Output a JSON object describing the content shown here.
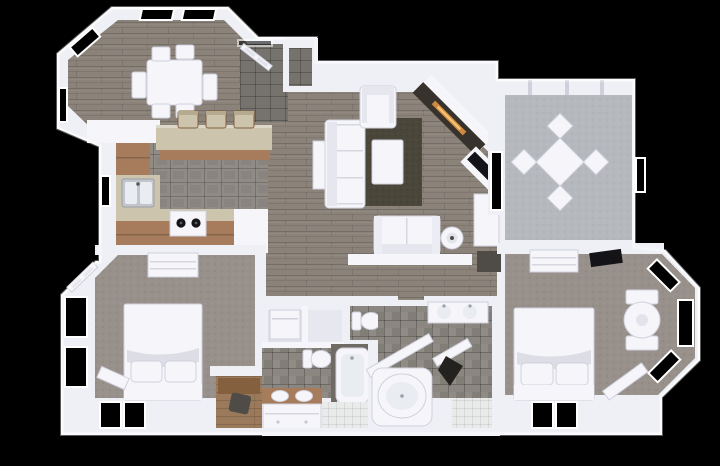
{
  "scene": {
    "title": "3D top-down render of a two-bedroom apartment floor plan on a black background",
    "view": "top-down 3D dollhouse render",
    "background": "#000000"
  },
  "palette": {
    "wall": "#eef0f5",
    "wallEdge": "#fbfbfd",
    "furniture": "#f6f6fa",
    "furnitureShade": "#cfd0dc",
    "wood": "#8b8279",
    "woodLine": "#6f675f",
    "entryTile": "#76726d",
    "kitchenTile": "#908b85",
    "counter": "#cdc4ae",
    "cabinet": "#a67c5c",
    "cabinetDark": "#84603f",
    "deskWood": "#9b7a5c",
    "carpet": "#98908a",
    "sunCarpet": "#b5b8bc",
    "rug": "#4a4639",
    "stone": "#38322c",
    "fire": "#d08a3e",
    "tv": "#141418",
    "steel": "#c2c6cc",
    "basin": "#e9ecf1",
    "bathTile": "#8b8680",
    "tileDark": "#6f6a64",
    "whiteTile": "#e9eaea",
    "windowVoid": "#000000",
    "matDark": "#4f4c47"
  },
  "rooms": [
    {
      "id": "dining-nook",
      "floor": "wood",
      "furniture": [
        "dining-table",
        "six-chairs"
      ]
    },
    {
      "id": "kitchen",
      "floor": "gray-tile",
      "furniture": [
        "breakfast-bar",
        "bar-stools-x3",
        "double-sink",
        "range-two-burners",
        "wood-cabinets",
        "refrigerator-cabinet"
      ]
    },
    {
      "id": "entry",
      "floor": "slate-tile",
      "furniture": [
        "front-door-open"
      ]
    },
    {
      "id": "coat-closet",
      "floor": "slate-tile",
      "furniture": []
    },
    {
      "id": "living-room",
      "floor": "wood",
      "furniture": [
        "sofa",
        "armchair",
        "loveseat",
        "coffee-table",
        "area-rug",
        "round-side-table",
        "corner-fireplace",
        "tv-on-angled-stand",
        "console-cabinet",
        "door-mat"
      ]
    },
    {
      "id": "sunroom",
      "floor": "light-gray-carpet",
      "furniture": [
        "square-table-diagonal",
        "four-chairs"
      ]
    },
    {
      "id": "bedroom-left",
      "floor": "carpet",
      "furniture": [
        "bed-with-pillows",
        "dresser",
        "corner-bench",
        "desk-nook-with-chair",
        "open-door"
      ]
    },
    {
      "id": "bedroom-right",
      "floor": "carpet",
      "furniture": [
        "bed-with-pillows",
        "dresser",
        "bay-window-round-table",
        "two-chairs",
        "angled-bench",
        "leaning-mirror"
      ]
    },
    {
      "id": "bathroom-left",
      "floor": "gray-tile",
      "furniture": [
        "double-vanity-wood-top",
        "bathtub",
        "toilet"
      ]
    },
    {
      "id": "bathroom-right",
      "floor": "gray-tile",
      "furniture": [
        "double-vanity-white",
        "garden-tub",
        "angled-shower-walls",
        "hanging-robe"
      ]
    },
    {
      "id": "water-closet",
      "floor": "gray-tile",
      "furniture": [
        "toilet"
      ]
    },
    {
      "id": "laundry-closet",
      "floor": "white",
      "furniture": [
        "washer",
        "shelf"
      ]
    },
    {
      "id": "hallway",
      "floor": "wood",
      "furniture": [
        "half-wall"
      ]
    }
  ]
}
